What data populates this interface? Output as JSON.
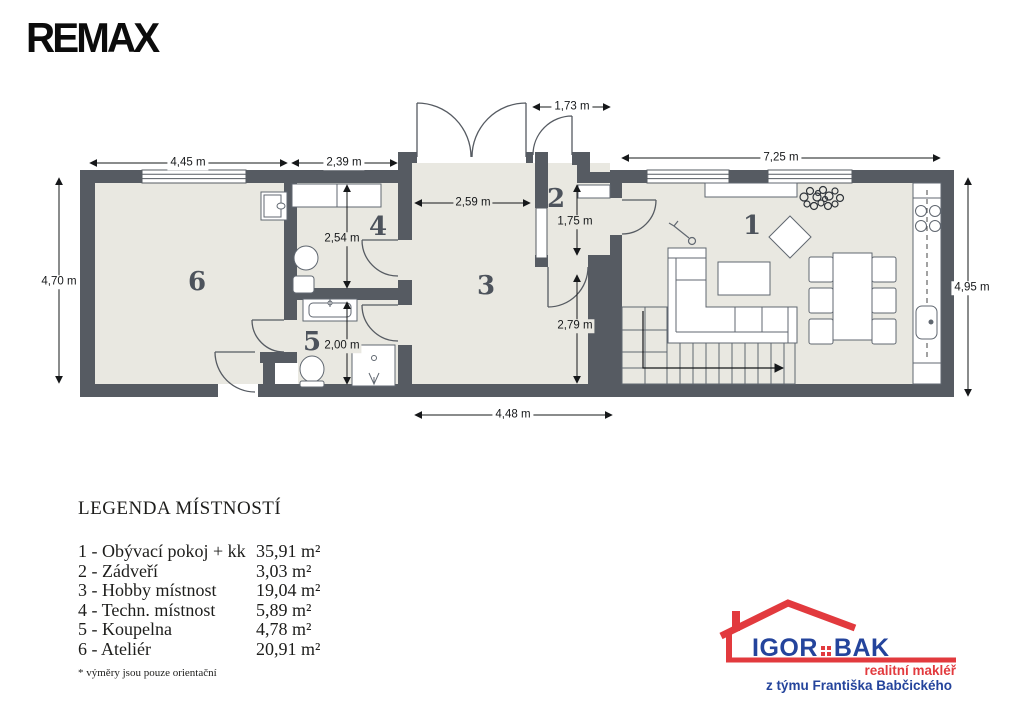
{
  "brand": {
    "remax": "REMAX"
  },
  "plan": {
    "rooms": [
      {
        "number": "1"
      },
      {
        "number": "2"
      },
      {
        "number": "3"
      },
      {
        "number": "4"
      },
      {
        "number": "5"
      },
      {
        "number": "6"
      }
    ],
    "dimensions": {
      "d445": "4,45 m",
      "d239": "2,39 m",
      "d173": "1,73 m",
      "d725": "7,25 m",
      "d470": "4,70 m",
      "d495": "4,95 m",
      "d448": "4,48 m",
      "d259": "2,59 m",
      "d254": "2,54 m",
      "d200": "2,00 m",
      "d175": "1,75 m",
      "d279": "2,79 m"
    }
  },
  "legend": {
    "title": "LEGENDA MÍSTNOSTÍ",
    "rows": [
      {
        "name": "1 - Obývací pokoj + kk",
        "area": "35,91 m²"
      },
      {
        "name": "2 - Zádveří",
        "area": "3,03 m²"
      },
      {
        "name": "3 - Hobby místnost",
        "area": "19,04 m²"
      },
      {
        "name": "4 - Techn. místnost",
        "area": "5,89 m²"
      },
      {
        "name": "5 - Koupelna",
        "area": "4,78 m²"
      },
      {
        "name": "6 - Ateliér",
        "area": "20,91 m²"
      }
    ],
    "footnote": "* výměry jsou pouze orientační"
  },
  "agent_logo": {
    "name_first": "IGOR",
    "name_last": "BAK",
    "tagline": "realitní makléř",
    "team": "z týmu Františka Babčického"
  },
  "colors": {
    "wall": "#565b62",
    "floor": "#e9e8e1",
    "red": "#e23a3e",
    "blue": "#24449c"
  }
}
